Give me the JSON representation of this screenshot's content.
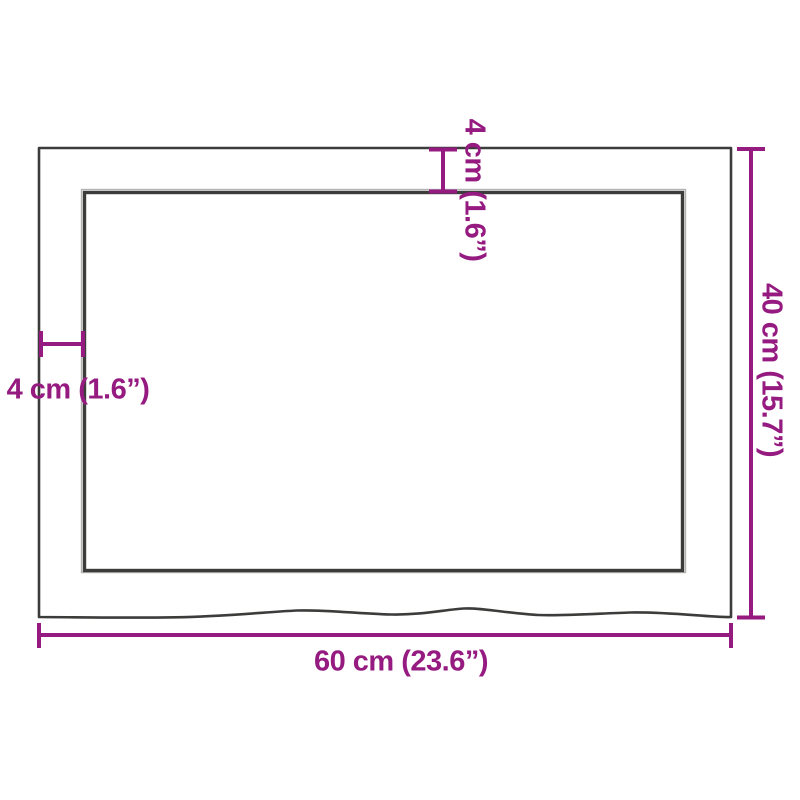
{
  "diagram": {
    "labels": {
      "width": "60 cm (23.6”)",
      "height": "40 cm (15.7”)",
      "thickness_top": "4 cm (1.6”)",
      "thickness_left": "4 cm (1.6”)"
    },
    "colors": {
      "accent": "#951B81",
      "line": "#3C3C3B",
      "background": "#FFFFFF"
    }
  }
}
